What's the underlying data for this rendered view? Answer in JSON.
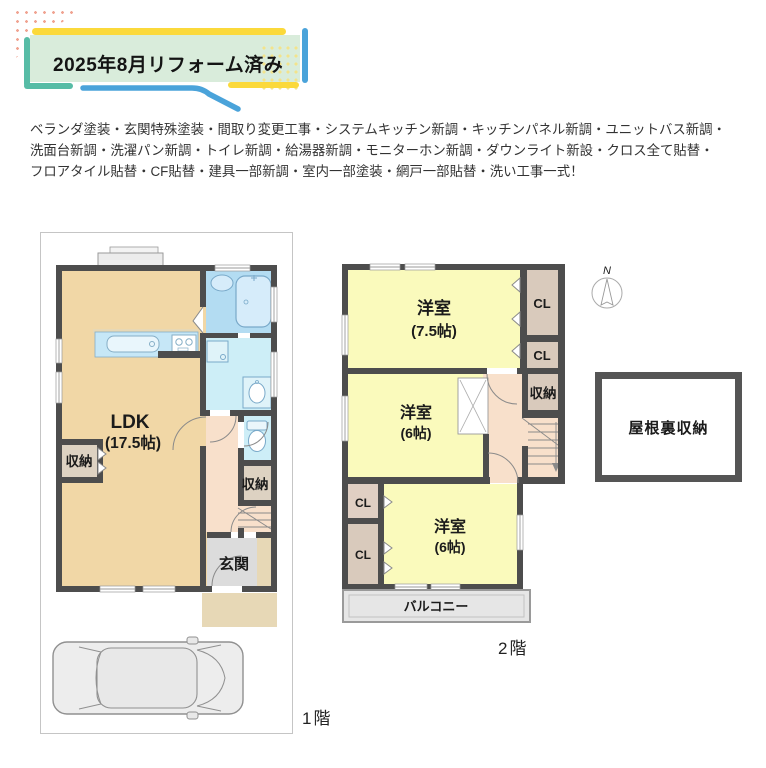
{
  "banner": {
    "title": "2025年8月リフォーム済み"
  },
  "renovation_note": {
    "line1": "ベランダ塗装・玄関特殊塗装・間取り変更工事・システムキッチン新調・キッチンパネル新調・ユニットバス新調・",
    "line2": "洗面台新調・洗濯パン新調・トイレ新調・給湯器新調・モニターホン新調・ダウンライト新設・クロス全て貼替・",
    "line3": "フロアタイル貼替・CF貼替・建具一部新調・室内一部塗装・網戸一部貼替・洗い工事一式！"
  },
  "floor1": {
    "floor_label": "1階",
    "ldk_name": "LDK",
    "ldk_size": "(17.5帖)",
    "storage_left": "収納",
    "storage_right": "収納",
    "entrance": "玄関"
  },
  "floor2": {
    "floor_label": "2階",
    "room75_name": "洋室",
    "room75_size": "(7.5帖)",
    "room6mid_name": "洋室",
    "room6mid_size": "(6帖)",
    "room6btm_name": "洋室",
    "room6btm_size": "(6帖)",
    "cl_top1": "CL",
    "cl_top2": "CL",
    "cl_left1": "CL",
    "cl_left2": "CL",
    "storage": "収納",
    "balcony": "バルコニー"
  },
  "attic": {
    "label": "屋根裏収納"
  },
  "compass": {
    "north": "N"
  },
  "colors": {
    "accent_yellow": "#fbd93b",
    "accent_blue": "#4aa3da",
    "accent_teal": "#57bca6",
    "banner_bg": "#d9ecdb",
    "wall": "#4d4d4d",
    "room_ldk": "#f1d7a6",
    "room_western": "#fafabc",
    "room_bath": "#b3dcf2",
    "room_washroom": "#cdeef7",
    "room_hall": "#f8e0cb",
    "room_storage": "#ddd2c2",
    "room_closet": "#d9cabc",
    "entrance_gray": "#dcdcdc",
    "porch_tan": "#e7d8b6",
    "balcony_gray": "#e6e6e6"
  }
}
